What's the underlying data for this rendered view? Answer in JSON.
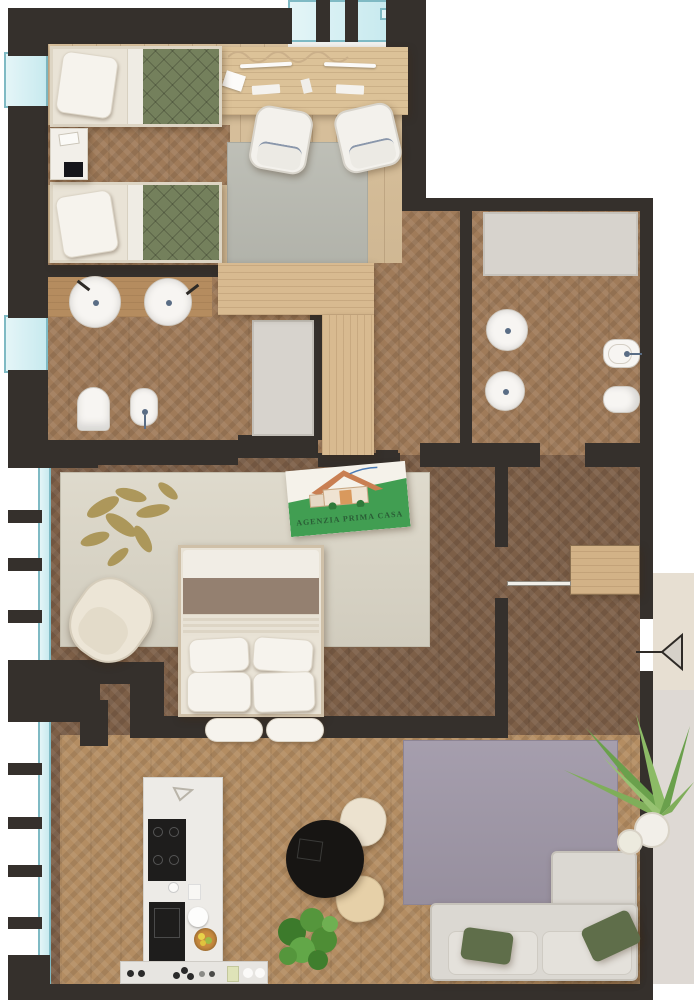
{
  "logo": {
    "title": "AGENZIA PRIMA CASA"
  },
  "icons": {
    "entry_door_arrow": "left-pointing-triangle",
    "logo_house": "house-illustration"
  },
  "theme": {
    "wall": "#35302c",
    "glass": "#c8eaef",
    "glassEdge": "#7fbac4",
    "glassLight": "#e4f5f7",
    "plank": "#d8bf99",
    "herrMid": "#a07b59",
    "herrDeep": "#7d5f47",
    "herrLive": "#b48d62",
    "counterWood": "#b58c5f",
    "wardrobe": "#d8ba90",
    "closet": "#d2b287",
    "deskWood": "#dcc298",
    "rugGray": "#b9bab1",
    "rugBeige": "#dcd7c8",
    "rugLav": "#a098a8",
    "leafGold": "#a8914f",
    "quilt": "#74805c",
    "linen": "#e9e3d6",
    "brownThrow": "#8b7465",
    "sofa": "#dbd8d2",
    "sofaEdge": "#c6c2ba",
    "cushGreen": "#5f6e4a",
    "island": "#edebe7",
    "applianceDark": "#1e1d1c",
    "tableBlack": "#171513",
    "chairCream": "#ece2cf",
    "chairTan": "#e6d0a8",
    "fixtureWhite": "#f7f5f2",
    "faucet": "#5a6d85",
    "showerTray": "#d7d3cd",
    "plantGreen": "#55923d",
    "palmGreen": "#7fae5a",
    "matBeige": "#e7dfd2",
    "terrace": "#ded9d4",
    "logoGreen": "#419e52",
    "logoRoof": "#c97f52",
    "logoText": "#2a5d36",
    "arrowFill": "#d6d1c9"
  }
}
